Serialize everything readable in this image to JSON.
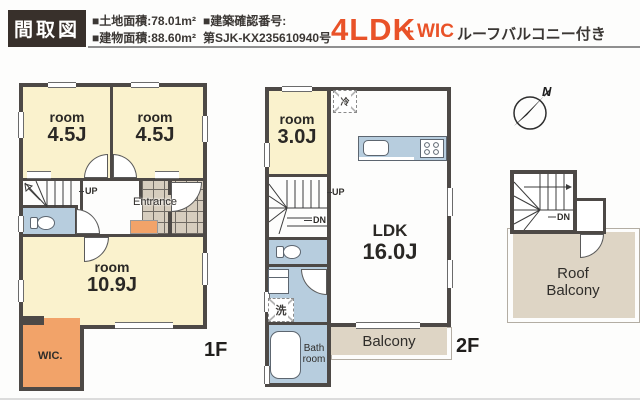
{
  "header": {
    "title": "間取図",
    "land_area": "■土地面積:78.01m²",
    "building_area": "■建物面積:88.60m²",
    "confirmation_label": "■建築確認番号:",
    "confirmation_number": "第SJK-KX235610940号",
    "layout": "4LDK",
    "plus": "+",
    "wic": "WIC",
    "feature": "ルーフバルコニー付き"
  },
  "floor1": {
    "label": "1F",
    "room_a": {
      "name": "room",
      "size": "4.5J"
    },
    "room_b": {
      "name": "room",
      "size": "4.5J"
    },
    "main_room": {
      "name": "room",
      "size": "10.9J"
    },
    "entrance": "Entrance",
    "up": "UP",
    "wic": "WIC."
  },
  "floor2": {
    "label": "2F",
    "room": {
      "name": "room",
      "size": "3.0J"
    },
    "ldk": {
      "name": "LDK",
      "size": "16.0J"
    },
    "up": "UP",
    "dn": "DN",
    "fridge": "冷",
    "laundry": "洗",
    "bath": "Bath room",
    "balcony": "Balcony"
  },
  "roof": {
    "dn": "DN",
    "balcony": "Roof Balcony",
    "compass_north": "N"
  },
  "colors": {
    "header_bg": "#38302b",
    "accent": "#e95228",
    "wall": "#4d4946",
    "cream": "#faf2cd",
    "wet": "#b7cdde",
    "orange": "#f2a369",
    "tile": "#d6cdbe",
    "balcony": "#ded5c5"
  }
}
